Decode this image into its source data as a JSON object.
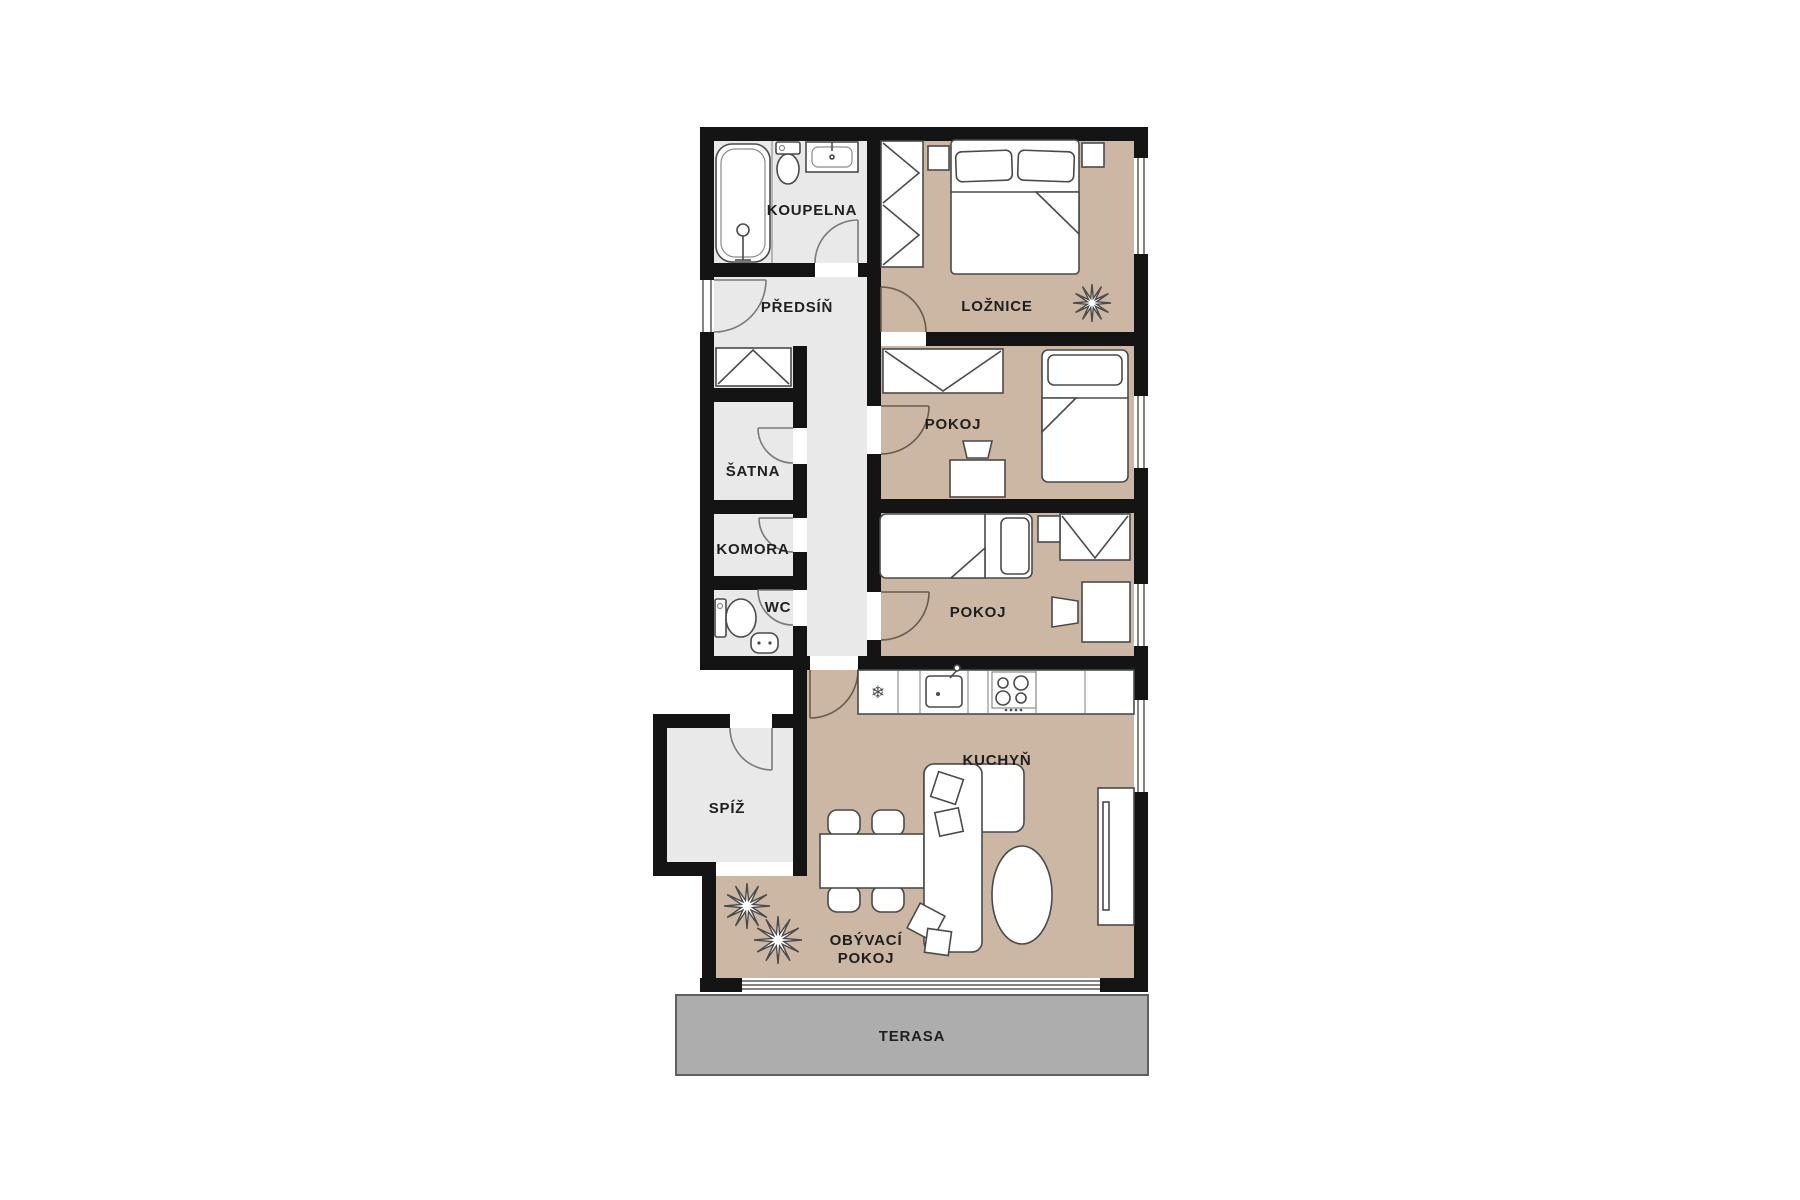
{
  "plan": {
    "type": "apartment-floor-plan",
    "colors": {
      "wall": "#141414",
      "floor_hall": "#e9e9e9",
      "floor_room": "#cbb7a3",
      "terrace": "#adadad",
      "furniture_outline": "#4a4a4a",
      "label_text": "#1f1f1f",
      "background": "#ffffff"
    },
    "rooms": {
      "koupelna": {
        "label": "KOUPELNA"
      },
      "predsin": {
        "label": "PŘEDSÍŇ"
      },
      "satna": {
        "label": "ŠATNA"
      },
      "komora": {
        "label": "KOMORA"
      },
      "wc": {
        "label": "WC"
      },
      "loznice": {
        "label": "LOŽNICE"
      },
      "pokoj1": {
        "label": "POKOJ"
      },
      "pokoj2": {
        "label": "POKOJ"
      },
      "kuchyn": {
        "label": "KUCHYŇ"
      },
      "spiz": {
        "label": "SPÍŽ"
      },
      "obyvaci_pokoj": {
        "label_line1": "OBÝVACÍ",
        "label_line2": "POKOJ"
      },
      "terasa": {
        "label": "TERASA"
      }
    },
    "icons": {
      "fridge_snowflake": "❄"
    }
  }
}
